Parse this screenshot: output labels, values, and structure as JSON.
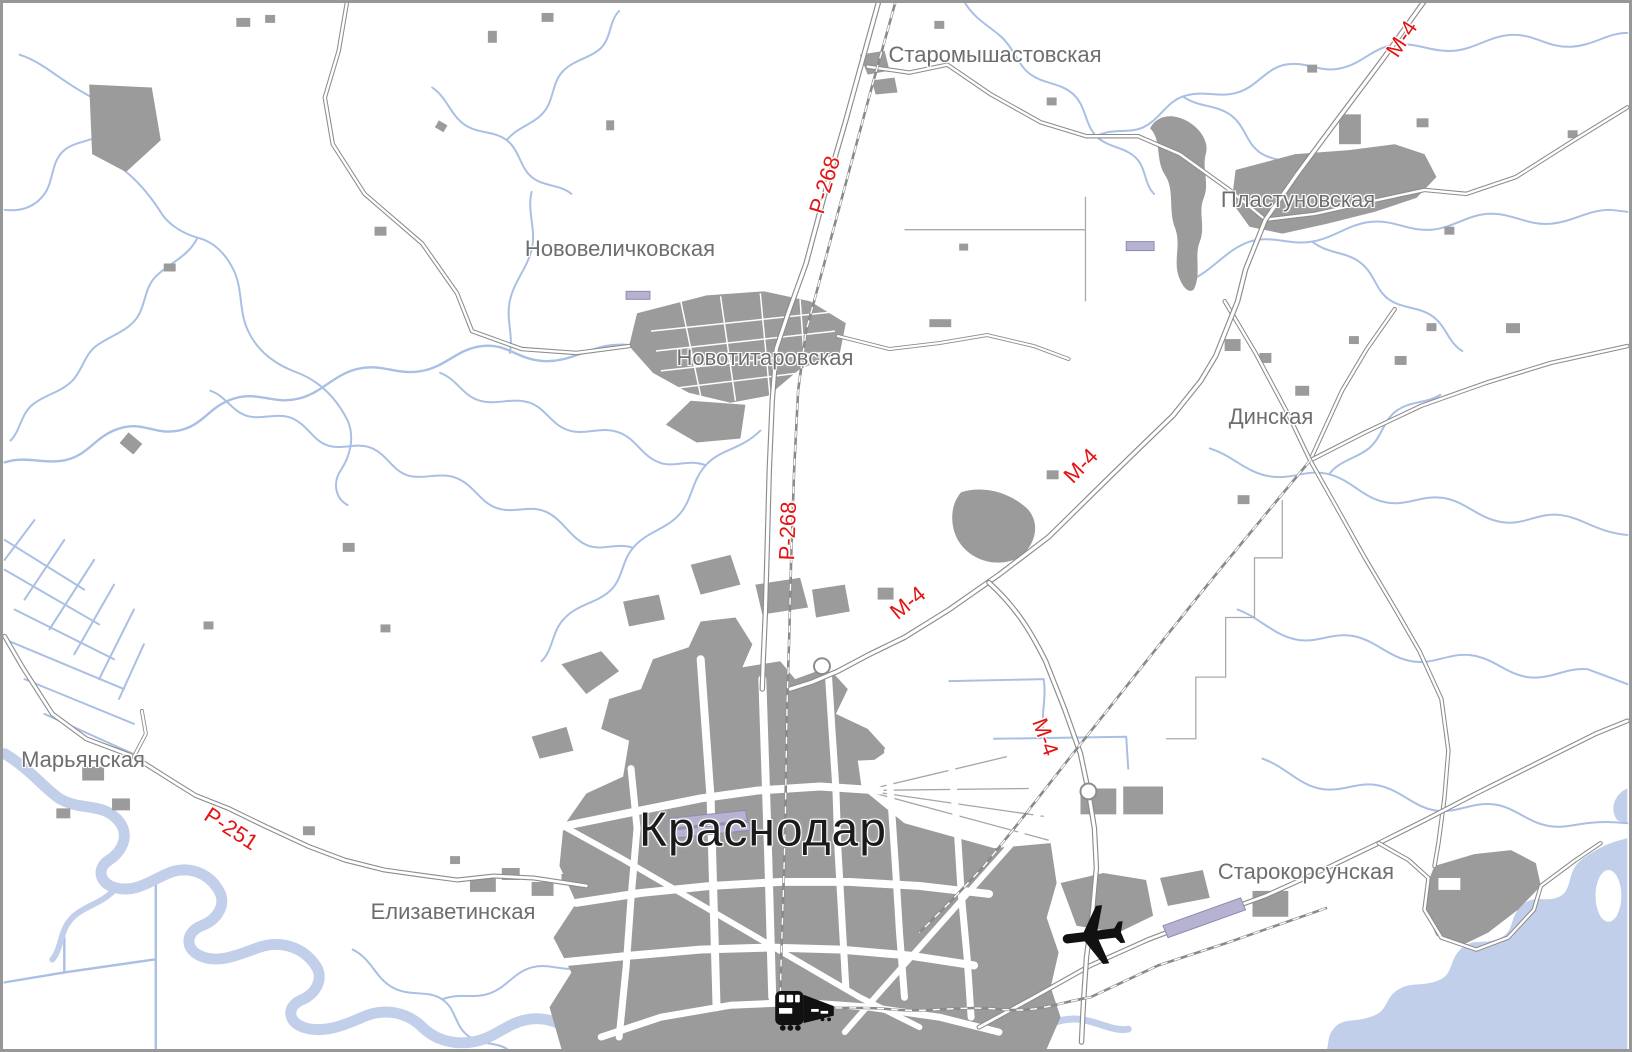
{
  "map": {
    "region_name": "Krasnodar area road map",
    "colors": {
      "water": "#a9bfe4",
      "water_fill": "#c2cfea",
      "urban": "#9b9b9b",
      "road_casing": "#8c8c8c",
      "road_fill": "#ffffff",
      "rail": "#8a8a8a",
      "label_town": "#6e6e6e",
      "label_city": "#1a1a1a",
      "label_road": "#e31414",
      "runway": "#b6b3d2",
      "frame": "#979797"
    },
    "labels": [
      {
        "id": "krasnodar",
        "kind": "city",
        "text": "Краснодар",
        "x": 760,
        "y": 827,
        "rot": 0
      },
      {
        "id": "staromyshastovskaya",
        "kind": "town",
        "text": "Старомышастовская",
        "x": 992,
        "y": 52,
        "rot": 0
      },
      {
        "id": "plastunovskaya",
        "kind": "town",
        "text": "Пластуновская",
        "x": 1295,
        "y": 197,
        "rot": 0
      },
      {
        "id": "novovelichkovskaya",
        "kind": "town",
        "text": "Нововеличковская",
        "x": 617,
        "y": 246,
        "rot": 0
      },
      {
        "id": "novotitarovskaya",
        "kind": "town",
        "text": "Новотитаровская",
        "x": 762,
        "y": 355,
        "rot": 0
      },
      {
        "id": "dinskaya",
        "kind": "town",
        "text": "Динская",
        "x": 1268,
        "y": 414,
        "rot": 0
      },
      {
        "id": "maryanskaya",
        "kind": "town",
        "text": "Марьянская",
        "x": 80,
        "y": 757,
        "rot": 0
      },
      {
        "id": "elizavetinskaya",
        "kind": "town",
        "text": "Елизаветинская",
        "x": 450,
        "y": 909,
        "rot": 0
      },
      {
        "id": "starokorsunskaya",
        "kind": "town",
        "text": "Старокорсунская",
        "x": 1303,
        "y": 869,
        "rot": 0
      },
      {
        "id": "r268-north",
        "kind": "road",
        "text": "Р-268",
        "x": 822,
        "y": 182,
        "rot": -73
      },
      {
        "id": "r268-south",
        "kind": "road",
        "text": "Р-268",
        "x": 785,
        "y": 528,
        "rot": -88
      },
      {
        "id": "m4-topright",
        "kind": "road",
        "text": "М-4",
        "x": 1399,
        "y": 36,
        "rot": -57
      },
      {
        "id": "m4-dinskaya",
        "kind": "road",
        "text": "М-4",
        "x": 1078,
        "y": 463,
        "rot": -46
      },
      {
        "id": "m4-middle",
        "kind": "road",
        "text": "М-4",
        "x": 905,
        "y": 600,
        "rot": -39
      },
      {
        "id": "m4-bypass",
        "kind": "road",
        "text": "М-4",
        "x": 1042,
        "y": 734,
        "rot": 70
      },
      {
        "id": "r251",
        "kind": "road",
        "text": "Р-251",
        "x": 228,
        "y": 826,
        "rot": 33
      }
    ],
    "icons": [
      {
        "id": "airplane",
        "x": 1095,
        "y": 938,
        "rot": -97
      },
      {
        "id": "train",
        "x": 775,
        "y": 988,
        "rot": 0
      }
    ]
  }
}
